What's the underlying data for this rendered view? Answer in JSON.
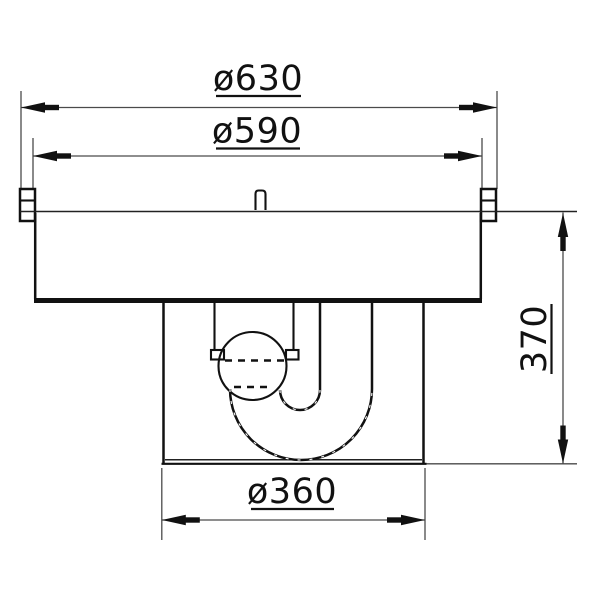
{
  "page": {
    "background": "#ffffff",
    "line_color": "#111111",
    "dimension_line_color": "#4a4a4a"
  },
  "drawing": {
    "type": "technical-section-drawing",
    "subject": "round-cover-with-siphon-trap-cross-section",
    "dimensions": [
      {
        "id": "outer-diameter",
        "label": "ø630",
        "value": 630,
        "orientation": "horizontal"
      },
      {
        "id": "inner-diameter",
        "label": "ø590",
        "value": 590,
        "orientation": "horizontal"
      },
      {
        "id": "trap-box-diameter",
        "label": "ø360",
        "value": 360,
        "orientation": "horizontal"
      },
      {
        "id": "overall-depth",
        "label": "370",
        "value": 370,
        "orientation": "vertical"
      }
    ]
  }
}
